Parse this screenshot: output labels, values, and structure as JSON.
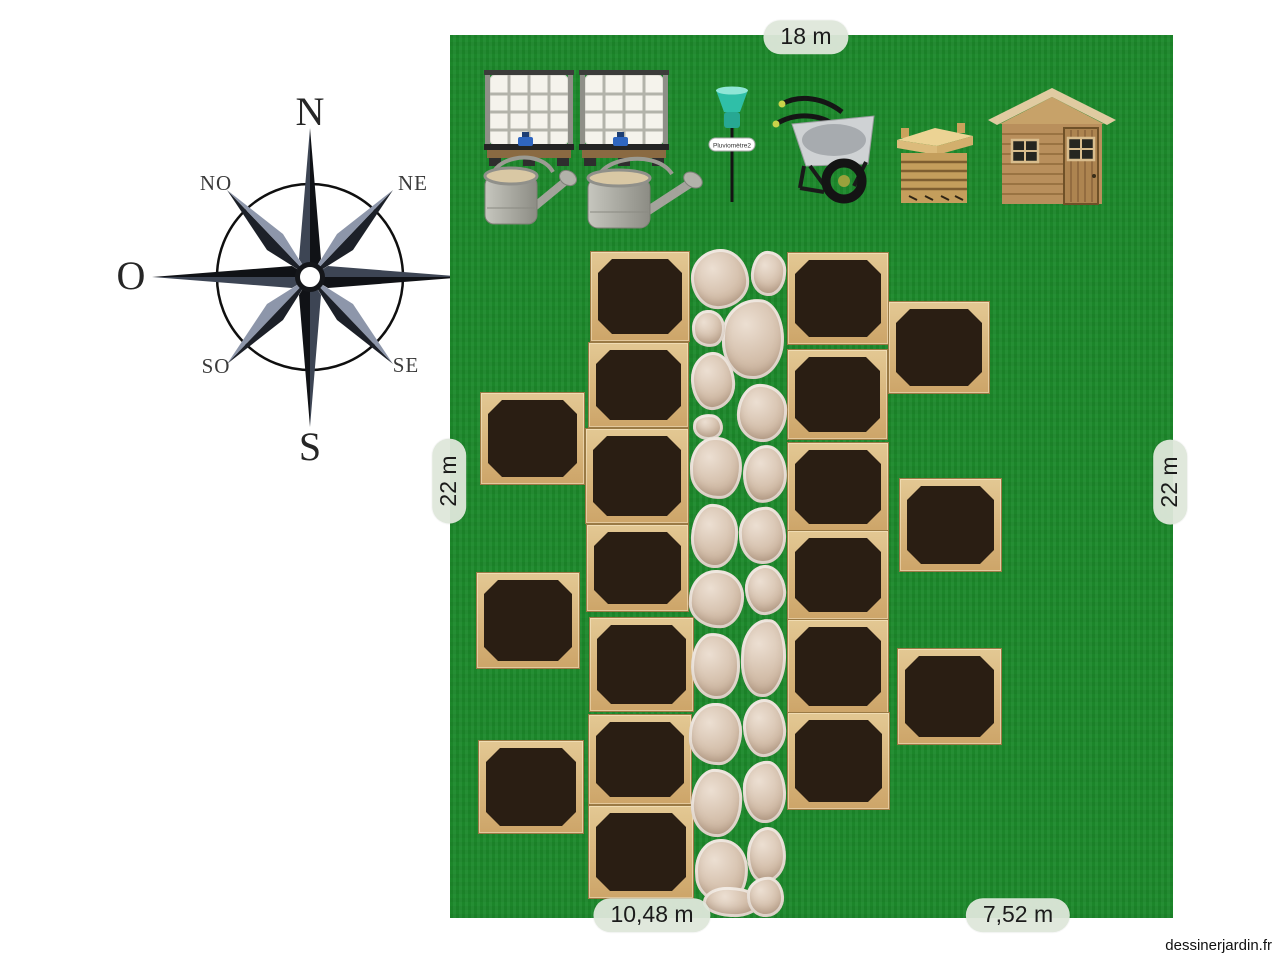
{
  "watermark": "dessinerjardin.fr",
  "compass": {
    "north": "N",
    "south": "S",
    "east": "E",
    "west": "O",
    "north_east": "NE",
    "north_west": "NO",
    "south_east": "SE",
    "south_west": "SO"
  },
  "dimensions": {
    "top": "18 m",
    "left": "22 m",
    "right": "22 m",
    "bottom_left": "10,48 m",
    "bottom_right": "7,52 m"
  },
  "equipment": {
    "rain_gauge_label": "Pluviomètre2",
    "items": [
      "water-tank-1",
      "water-tank-2",
      "watering-can-1",
      "watering-can-2",
      "rain-gauge",
      "wheelbarrow",
      "composter",
      "garden-shed"
    ]
  },
  "garden": {
    "grass_color": "#1e8a2d",
    "soil_color": "#2a1e13",
    "wood_light": "#e3c893",
    "wood_dark": "#cda569",
    "stone_color": "#d4bfab",
    "beds": [
      [
        480,
        392,
        103,
        91
      ],
      [
        476,
        572,
        102,
        95
      ],
      [
        478,
        740,
        104,
        92
      ],
      [
        590,
        251,
        98,
        89
      ],
      [
        588,
        342,
        99,
        84
      ],
      [
        585,
        428,
        102,
        94
      ],
      [
        586,
        524,
        101,
        86
      ],
      [
        589,
        617,
        103,
        93
      ],
      [
        588,
        714,
        102,
        89
      ],
      [
        588,
        805,
        104,
        92
      ],
      [
        787,
        252,
        100,
        91
      ],
      [
        787,
        349,
        99,
        89
      ],
      [
        787,
        442,
        100,
        88
      ],
      [
        787,
        530,
        100,
        88
      ],
      [
        787,
        619,
        100,
        93
      ],
      [
        787,
        712,
        101,
        96
      ],
      [
        888,
        301,
        100,
        91
      ],
      [
        899,
        478,
        101,
        92
      ],
      [
        897,
        648,
        103,
        95
      ]
    ],
    "stone_radii": [
      "52% 48% 55% 45% / 48% 55% 45% 52%",
      "45% 55% 48% 52% / 55% 45% 52% 48%",
      "58% 42% 50% 50% / 46% 54% 50% 50%",
      "50% 50% 44% 56% / 52% 48% 56% 44%"
    ],
    "path_stones": [
      [
        691,
        249,
        58,
        60,
        -3
      ],
      [
        751,
        251,
        35,
        45,
        4
      ],
      [
        722,
        299,
        62,
        80,
        2
      ],
      [
        692,
        310,
        33,
        37,
        -6
      ],
      [
        691,
        352,
        44,
        58,
        -3
      ],
      [
        737,
        384,
        50,
        58,
        3
      ],
      [
        693,
        414,
        30,
        26,
        5
      ],
      [
        690,
        437,
        52,
        62,
        -2
      ],
      [
        743,
        445,
        44,
        58,
        4
      ],
      [
        691,
        504,
        47,
        64,
        2
      ],
      [
        739,
        507,
        47,
        57,
        -3
      ],
      [
        689,
        570,
        55,
        58,
        3
      ],
      [
        745,
        565,
        41,
        50,
        -4
      ],
      [
        691,
        633,
        49,
        66,
        -2
      ],
      [
        741,
        619,
        45,
        78,
        3
      ],
      [
        689,
        703,
        53,
        62,
        2
      ],
      [
        743,
        699,
        43,
        58,
        -3
      ],
      [
        691,
        769,
        51,
        68,
        3
      ],
      [
        743,
        761,
        43,
        62,
        -2
      ],
      [
        695,
        839,
        53,
        64,
        -3
      ],
      [
        747,
        827,
        39,
        56,
        3
      ],
      [
        703,
        887,
        57,
        30,
        2
      ],
      [
        747,
        877,
        37,
        40,
        -4
      ]
    ]
  }
}
